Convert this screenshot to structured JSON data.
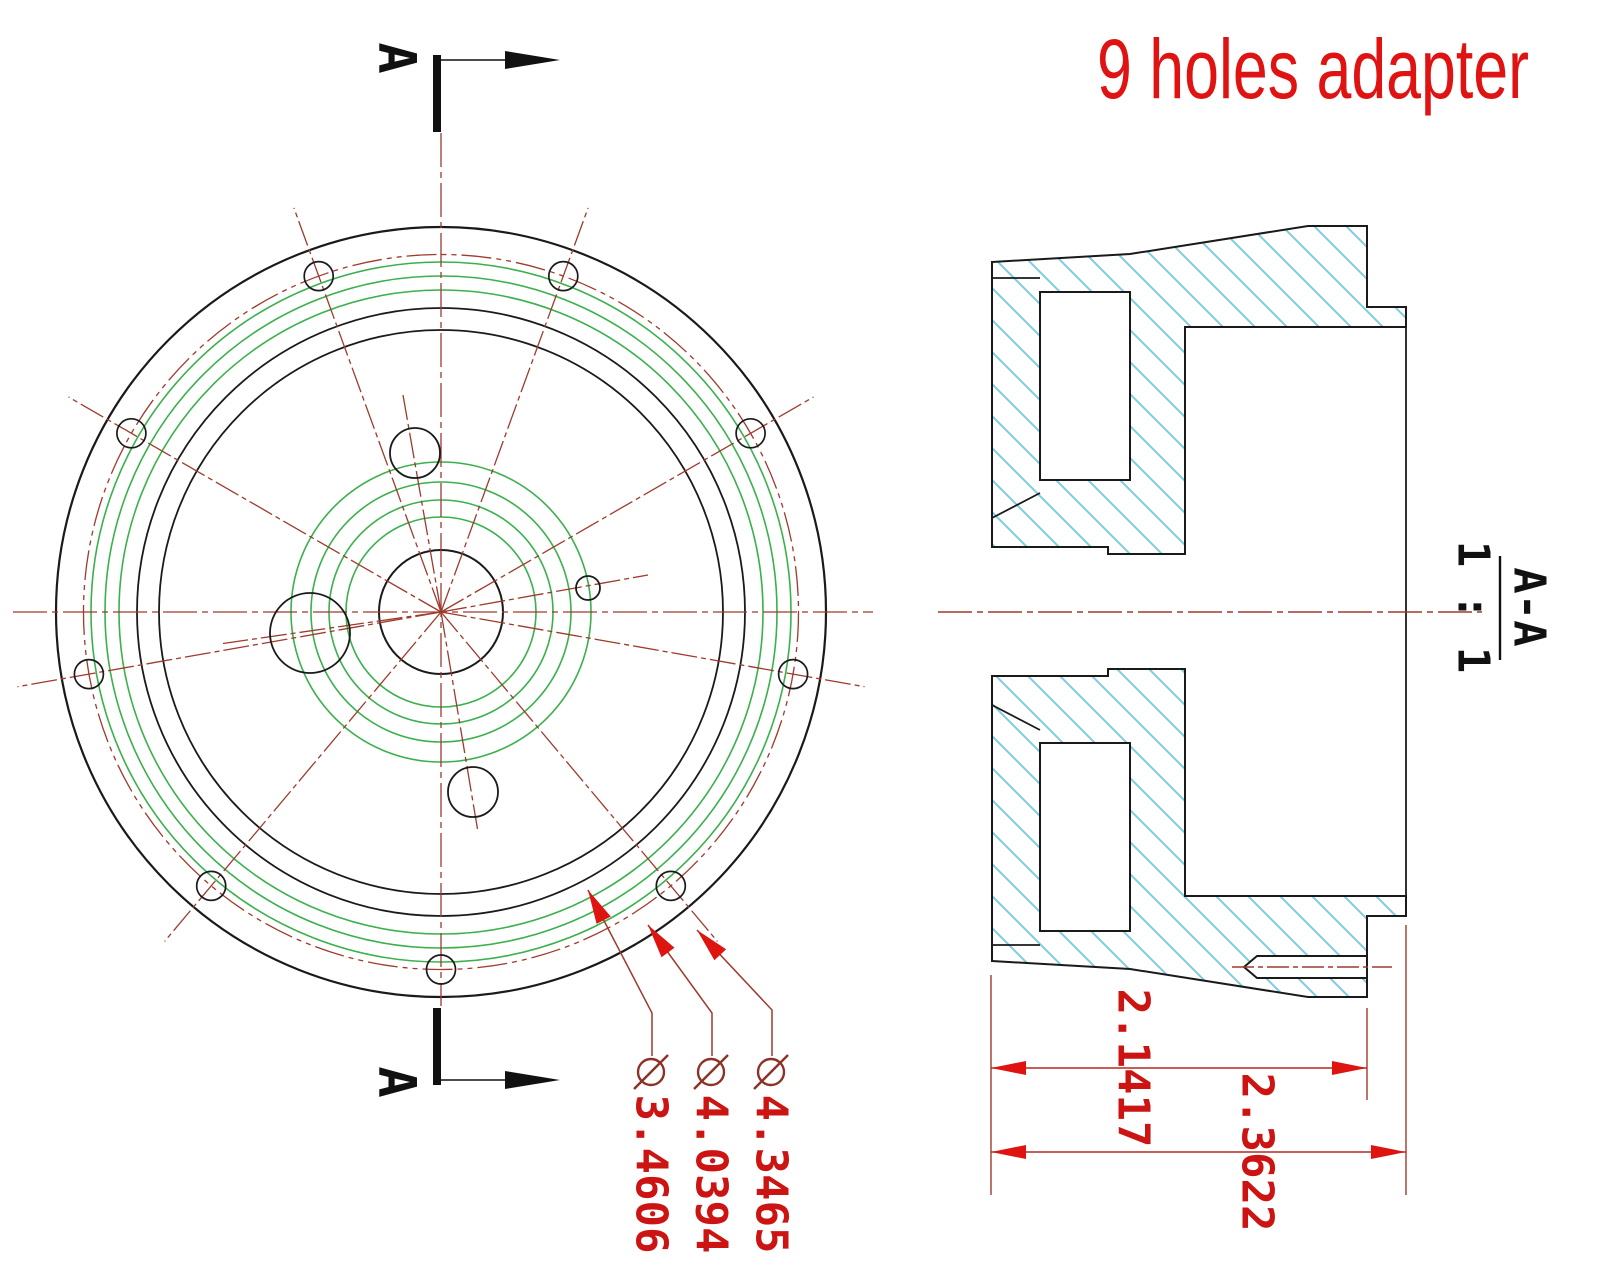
{
  "title": "9 holes adapter",
  "front_view": {
    "bolt_hole_count": 9,
    "section_marker_top": "A",
    "section_marker_bottom": "A"
  },
  "section_view": {
    "name": "A-A",
    "scale": "1 : 1"
  },
  "dimensions": {
    "width_to_step": "2.1417",
    "width_overall": "2.3622",
    "diameter_labels": [
      {
        "symbol": "⌀",
        "value": "3.4606"
      },
      {
        "symbol": "⌀",
        "value": "4.0394"
      },
      {
        "symbol": "⌀",
        "value": "4.3465"
      }
    ]
  },
  "colors": {
    "outline": "#1a1a1a",
    "centerline_red": "#9e3a2c",
    "dimension_red": "#cc1513",
    "thread_green": "#3bb04c",
    "hatch_cyan": "#7fccdd",
    "title_red": "#e01313"
  }
}
